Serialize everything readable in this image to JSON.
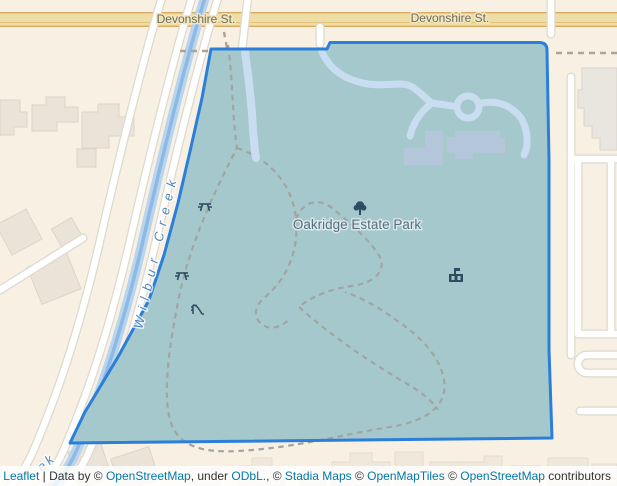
{
  "map": {
    "labels": {
      "street_top_left": "Devonshire St.",
      "street_top_right": "Devonshire St.",
      "creek": "Wilbur Creek",
      "creek_partial": "ek",
      "park": "Oakridge Estate Park"
    },
    "icons": [
      {
        "name": "tree-icon",
        "meaning": "park point of interest (tree)"
      },
      {
        "name": "picnic-table-icon",
        "meaning": "picnic site"
      },
      {
        "name": "picnic-table-icon",
        "meaning": "picnic site"
      },
      {
        "name": "playground-icon",
        "meaning": "playground slide"
      },
      {
        "name": "manor-icon",
        "meaning": "historic estate building"
      }
    ],
    "colors": {
      "background": "#f7f0e3",
      "park_overlay_fill": "#a5c8cd",
      "park_overlay_border": "#2b7fd9",
      "major_road_fill": "#eedda4",
      "major_road_border": "#d8a95e",
      "creek_water": "#8fb9e2",
      "creek_water_light": "#b7d5ef",
      "inner_path": "#c9ddf1",
      "estate_building": "#b4c7da",
      "icon_color": "#2e4d63",
      "link_color": "#0078A8"
    }
  },
  "attribution": {
    "parts": [
      {
        "text": "Leaflet",
        "link": true
      },
      {
        "text": " | Data by © ",
        "link": false
      },
      {
        "text": "OpenStreetMap",
        "link": true
      },
      {
        "text": ", under ",
        "link": false
      },
      {
        "text": "ODbL.",
        "link": true
      },
      {
        "text": ", © ",
        "link": false
      },
      {
        "text": "Stadia Maps",
        "link": true
      },
      {
        "text": " © ",
        "link": false
      },
      {
        "text": "OpenMapTiles",
        "link": true
      },
      {
        "text": " © ",
        "link": false
      },
      {
        "text": "OpenStreetMap",
        "link": true
      },
      {
        "text": " contributors",
        "link": false
      }
    ]
  }
}
